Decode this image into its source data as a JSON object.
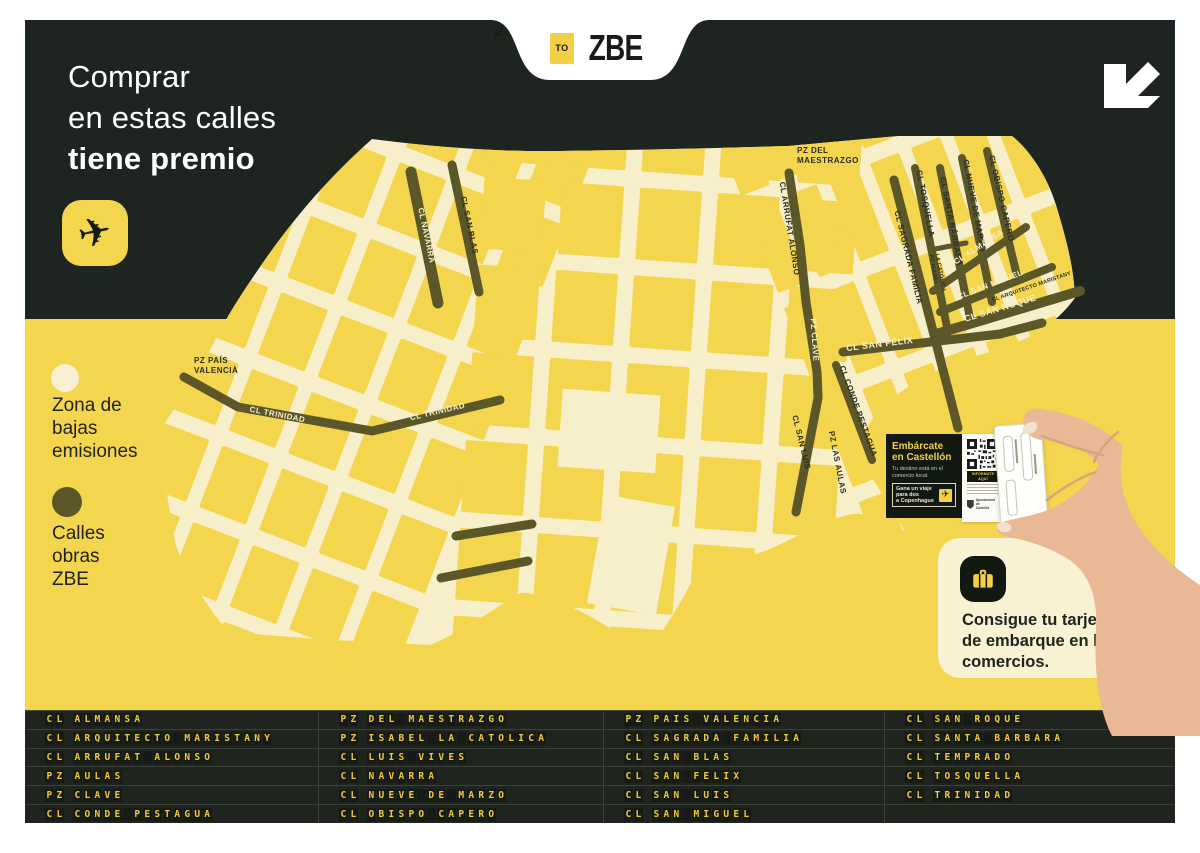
{
  "colors": {
    "background_dark": "#1E2420",
    "yellow": "#F4D54E",
    "cream_zone": "#F6EFCA",
    "street_olive": "#5B5729",
    "board_text_yellow": "#F2C93E",
    "white": "#FFFFFF"
  },
  "header": {
    "title_line1": "Comprar",
    "title_line2": "en estas calles",
    "title_line3": "tiene premio",
    "logo_to": "TO",
    "logo_zbe": "ZBE"
  },
  "legend": {
    "zone_label": "Zona de\nbajas\nemisiones",
    "works_label": "Calles\nobras\nZBE"
  },
  "map": {
    "labels": {
      "navarra": "CL NAVARRA",
      "san_blas": "CL SAN BLAS",
      "trinidad_a": "CL TRINIDAD",
      "trinidad_b": "CL TRINIDAD",
      "pais_1": "PZ PAÍS",
      "pais_2": "VALENCIÀ",
      "temprado": "CL TEMPRADO",
      "luis_vives": "CL LUIS VIVES",
      "maestrazgo_1": "PZ DEL",
      "maestrazgo_2": "MAESTRAZGO",
      "arrufat": "CL ARRUFAT ALONSO",
      "clave": "PZ CLAVE",
      "san_luis": "CL SAN LUIS",
      "las_aulas": "PZ LAS AULAS",
      "conde": "CL CONDE PESTAGUA",
      "san_felix": "CL SAN FÉLIX",
      "tosquella": "CL TOSQUELLA",
      "sagrada": "CL SAGRADA FAMILIA",
      "santa_barbara": "CL SANTA BÁRBARA",
      "isabel_1": "PZ ISABEL",
      "isabel_2": "LA CATÓLICA",
      "nueve": "CL NUEVE DE MARZO",
      "obispo": "CL OBISPO CAPERO",
      "almansa": "CL ALMANSA",
      "san_miguel": "CL SAN MIGUEL",
      "maristany": "CL ARQUITECTO MARISTANY",
      "san_roque": "CL SAN ROQUE"
    }
  },
  "card": {
    "title": "Embárcate\nen Castellón",
    "subtitle": "Tu destino está en el\ncomercio local.",
    "promo": "Gana un viaje\npara dos\na Copenhague",
    "qr_label": "INFÓRMATE AQUÍ",
    "logo_text": "Ajuntament de\nCastelló"
  },
  "panel": {
    "text": "Consigue tu tarjeta\nde embarque en los\ncomercios."
  },
  "board": {
    "columns": [
      [
        "CL ALMANSA",
        "CL ARQUITECTO MARISTANY",
        "CL ARRUFAT ALONSO",
        "PZ AULAS",
        "PZ CLAVE",
        "CL CONDE PESTAGUA"
      ],
      [
        "PZ DEL MAESTRAZGO",
        "PZ ISABEL LA CATOLICA",
        "CL LUIS VIVES",
        "CL NAVARRA",
        "CL NUEVE DE MARZO",
        "CL OBISPO CAPERO"
      ],
      [
        "PZ PAIS VALENCIA",
        "CL SAGRADA FAMILIA",
        "CL SAN BLAS",
        "CL SAN FELIX",
        "CL SAN LUIS",
        "CL SAN MIGUEL"
      ],
      [
        "CL SAN ROQUE",
        "CL SANTA BARBARA",
        "CL TEMPRADO",
        "CL TOSQUELLA",
        "CL TRINIDAD",
        ""
      ]
    ]
  }
}
